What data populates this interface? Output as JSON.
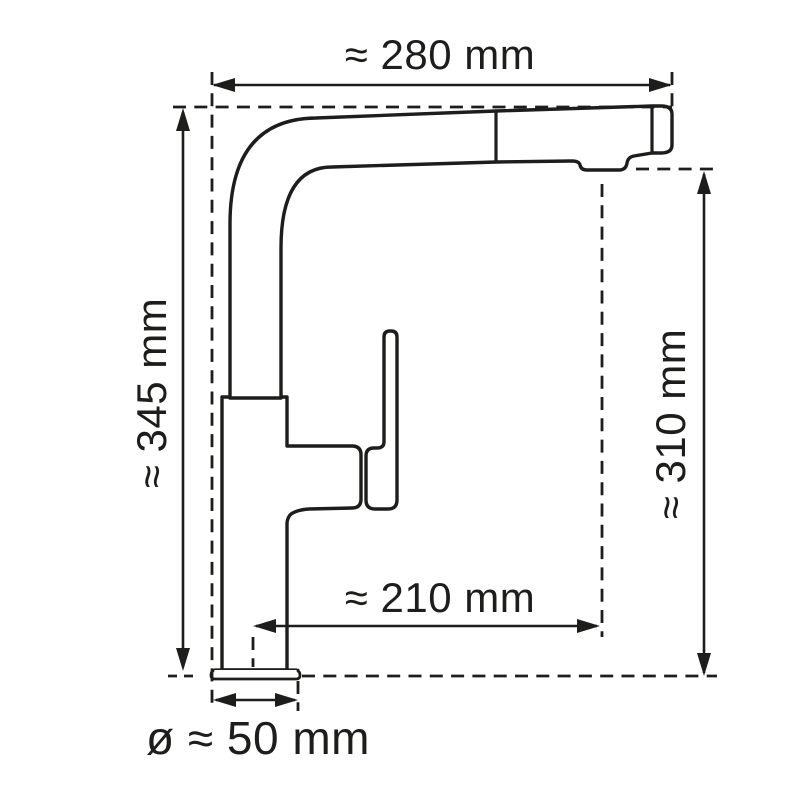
{
  "colors": {
    "line": "#1d1d1b",
    "background": "#ffffff"
  },
  "drawing": {
    "kind": "technical dimension drawing",
    "subject": "pull-out kitchen faucet, side profile"
  },
  "dimensions": {
    "top_width": "≈ 280 mm",
    "left_height": "≈ 345 mm",
    "right_height": "≈ 310 mm",
    "spout_reach": "≈ 210 mm",
    "base_diameter": "ø ≈ 50 mm"
  }
}
